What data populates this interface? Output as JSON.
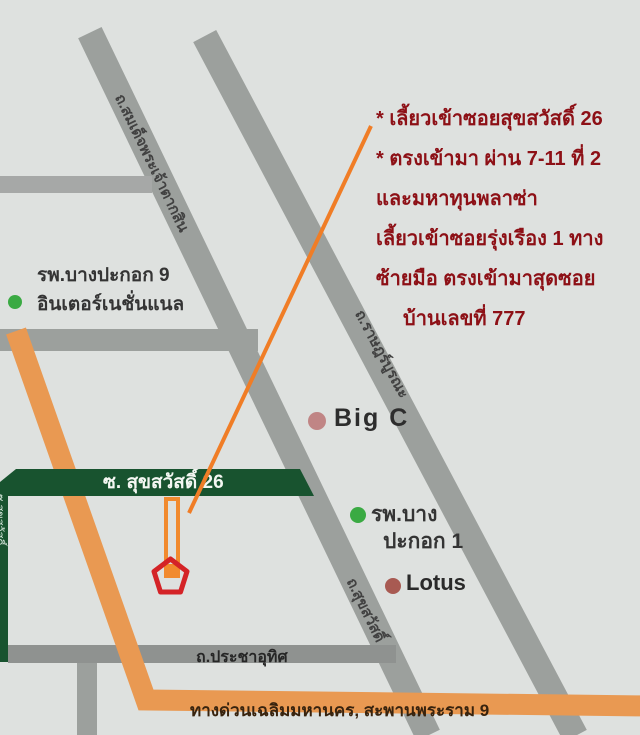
{
  "directions": {
    "color": "#8d1016",
    "lines": [
      "* เลี้ยวเข้าซอยสุขสวัสดิ์ 26",
      "* ตรงเข้ามา ผ่าน 7-11 ที่ 2",
      "และมหาทุนพลาซ่า",
      "เลี้ยวเข้าซอยรุ่งเรือง 1 ทาง",
      "ซ้ายมือ ตรงเข้ามาสุดซอย",
      "บ้านเลขที่ 777"
    ]
  },
  "roads": {
    "taksin": "ถ.สมเด็จพระเจ้าตากสิน",
    "ratburana": "ถ.ราษฎร์บูรณะ",
    "suksawat": "ถ.สุขสวัสดิ์",
    "prachauthit": "ถ.ประชาอุทิศ",
    "expressway": "ทางด่วนเฉลิมมหานคร, สะพานพระราม 9",
    "soi_banner": "ซ. สุขสวัสดิ์ 26",
    "soi_strip_partial": "ซ.สุขสวัสดิ์"
  },
  "places": {
    "hospital9": {
      "line1": "รพ.บางปะกอก 9",
      "line2": "อินเตอร์เนชั่นแนล",
      "dot_color": "#3aaa43"
    },
    "bigc": {
      "label": "Big C",
      "dot_color": "#c08585"
    },
    "hospital1": {
      "line1": "รพ.บาง",
      "line2": "ปะกอก 1",
      "dot_color": "#3aaa43"
    },
    "lotus": {
      "label": "Lotus",
      "dot_color": "#a85a52"
    }
  },
  "colors": {
    "background": "#dee1df",
    "road_gray": "#9ca09d",
    "green_road": "#18532f",
    "orange_route": "#e99952",
    "pointer_orange": "#f07d26",
    "target_rect_orange": "#f18a2e",
    "house_marker_red": "#d42327",
    "directions_red": "#8d1016"
  }
}
